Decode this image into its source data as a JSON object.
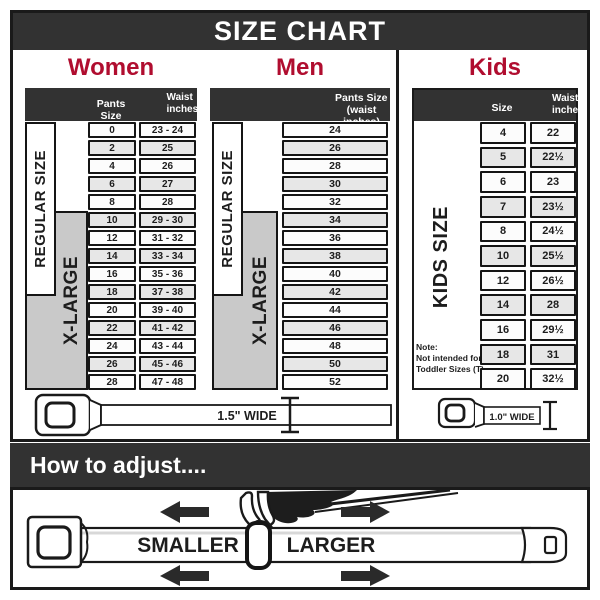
{
  "title": "SIZE CHART",
  "colors": {
    "accent": "#B00D2F",
    "dark": "#323232",
    "xl_gray": "#C9C9C9",
    "line": "#1A1A1A"
  },
  "women": {
    "heading": "Women",
    "col1": "Pants Size",
    "col2_line1": "Waist",
    "col2_line2": "inches",
    "regular_label": "REGULAR SIZE",
    "xlarge_label": "X-LARGE",
    "rows": [
      {
        "size": "0",
        "waist": "23 - 24"
      },
      {
        "size": "2",
        "waist": "25"
      },
      {
        "size": "4",
        "waist": "26"
      },
      {
        "size": "6",
        "waist": "27"
      },
      {
        "size": "8",
        "waist": "28"
      },
      {
        "size": "10",
        "waist": "29 - 30"
      },
      {
        "size": "12",
        "waist": "31 - 32"
      },
      {
        "size": "14",
        "waist": "33 - 34"
      },
      {
        "size": "16",
        "waist": "35 - 36"
      },
      {
        "size": "18",
        "waist": "37 - 38"
      },
      {
        "size": "20",
        "waist": "39 - 40"
      },
      {
        "size": "22",
        "waist": "41 - 42"
      },
      {
        "size": "24",
        "waist": "43 - 44"
      },
      {
        "size": "26",
        "waist": "45 - 46"
      },
      {
        "size": "28",
        "waist": "47 - 48"
      }
    ]
  },
  "men": {
    "heading": "Men",
    "col_line1": "Pants Size",
    "col_line2": "(waist inches)",
    "regular_label": "REGULAR SIZE",
    "xlarge_label": "X-LARGE",
    "rows": [
      "24",
      "26",
      "28",
      "30",
      "32",
      "34",
      "36",
      "38",
      "40",
      "42",
      "44",
      "46",
      "48",
      "50",
      "52"
    ]
  },
  "kids": {
    "heading": "Kids",
    "col1": "Size",
    "col2_line1": "Waist",
    "col2_line2": "inches",
    "side_label": "KIDS SIZE",
    "note": [
      "Note:",
      "Not intended for",
      "Toddler Sizes (T)"
    ],
    "rows": [
      {
        "size": "4",
        "waist": "22"
      },
      {
        "size": "5",
        "waist": "22½"
      },
      {
        "size": "6",
        "waist": "23"
      },
      {
        "size": "7",
        "waist": "23½"
      },
      {
        "size": "8",
        "waist": "24½"
      },
      {
        "size": "10",
        "waist": "25½"
      },
      {
        "size": "12",
        "waist": "26½"
      },
      {
        "size": "14",
        "waist": "28"
      },
      {
        "size": "16",
        "waist": "29½"
      },
      {
        "size": "18",
        "waist": "31"
      },
      {
        "size": "20",
        "waist": "32½"
      }
    ]
  },
  "belts": {
    "adult_width_label": "1.5\" WIDE",
    "kids_width_label": "1.0\" WIDE"
  },
  "adjust": {
    "heading": "How to adjust....",
    "smaller_label": "SMALLER",
    "larger_label": "LARGER"
  },
  "icons": {
    "adult_belt": "seatbelt-buckle-belt",
    "kids_belt": "seatbelt-buckle-belt-small",
    "width_marker": "i-beam-measure-marker",
    "hand": "hand-pulling-strap",
    "arrows": "left-right-adjust-arrows"
  }
}
